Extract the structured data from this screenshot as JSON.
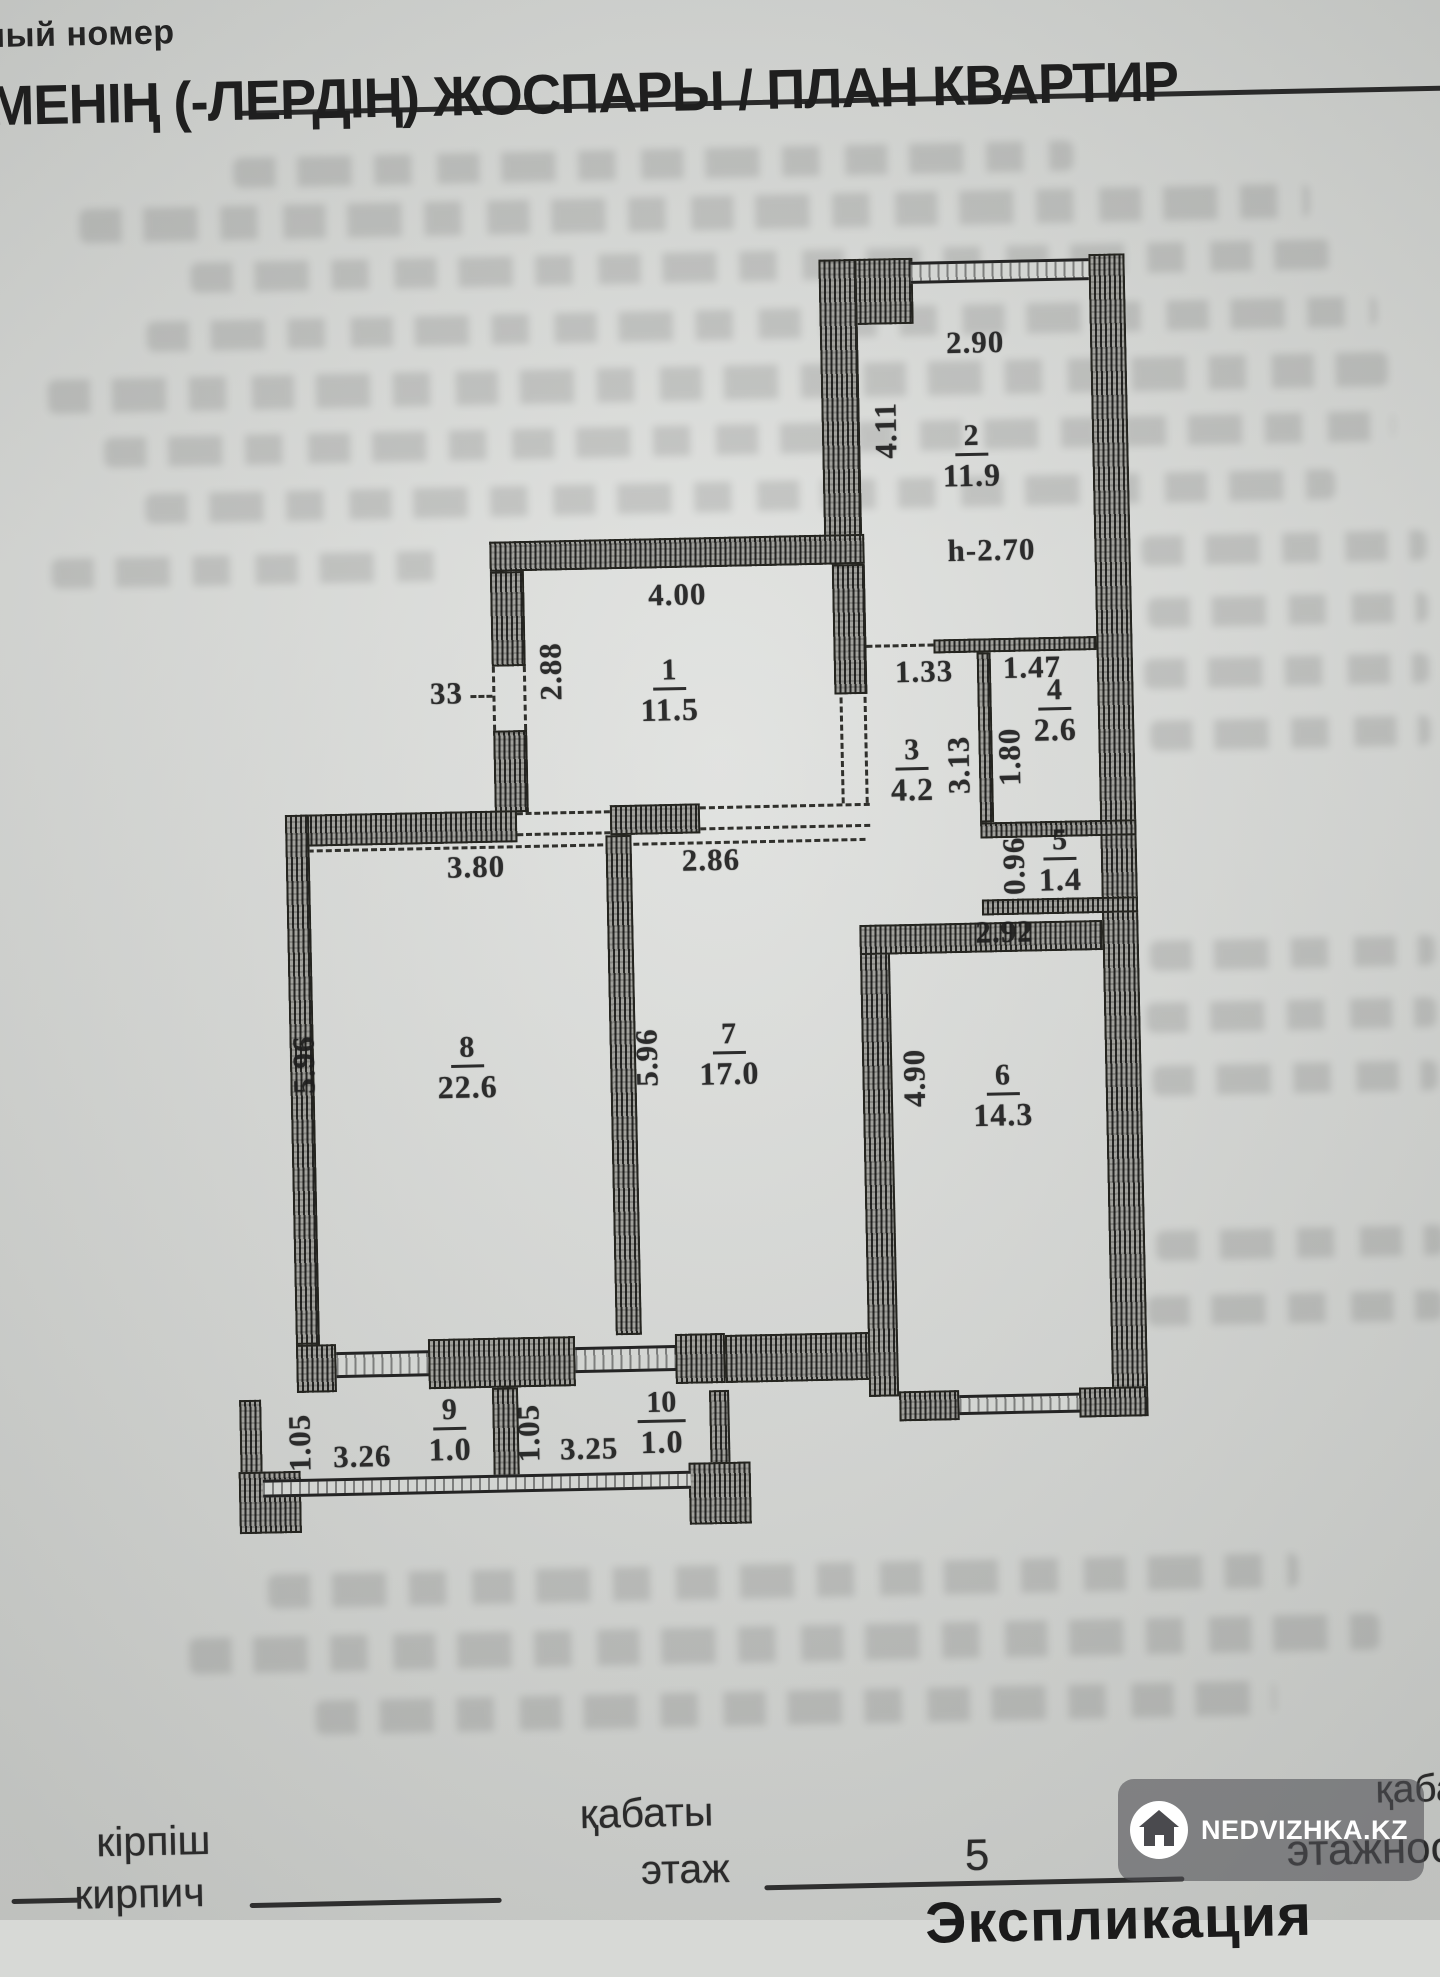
{
  "document": {
    "top_left_partial": "ный номер",
    "title_partial": "ЛМЕНІҢ (-ЛЕРДІҢ) ЖОСПАРЫ / ПЛАН КВАРТИР",
    "section_bottom_partial": "Экспликация"
  },
  "plan": {
    "rooms": [
      {
        "number": "1",
        "area": "11.5",
        "width": "4.00",
        "depth": "2.88",
        "window": "33"
      },
      {
        "number": "2",
        "area": "11.9",
        "width": "2.90",
        "depth": "4.11",
        "ceiling_height": "h-2.70"
      },
      {
        "number": "3",
        "area": "4.2",
        "width": "1.33",
        "depth": "3.13"
      },
      {
        "number": "4",
        "area": "2.6",
        "width": "1.47",
        "depth": "1.80"
      },
      {
        "number": "5",
        "area": "1.4",
        "depth": "0.96"
      },
      {
        "number": "6",
        "area": "14.3",
        "width": "2.92",
        "depth": "4.90"
      },
      {
        "number": "7",
        "area": "17.0",
        "width": "2.86",
        "depth": "5.96"
      },
      {
        "number": "8",
        "area": "22.6",
        "width": "3.80",
        "depth": "5.96"
      },
      {
        "number": "9",
        "area": "1.0",
        "width": "3.26",
        "depth": "1.05"
      },
      {
        "number": "10",
        "area": "1.0",
        "width": "3.25",
        "depth": "1.05"
      }
    ]
  },
  "footer": {
    "wall_material_kk": "кірпіш",
    "wall_material_ru": "кирпич",
    "floor_label_kk": "қабаты",
    "floor_label_ru": "этаж",
    "floor_value": "5",
    "storeys_label_kk_partial": "қабат-ғы",
    "storeys_label_ru_partial": "этажност"
  },
  "watermark": {
    "text": "NEDVIZHKA.KZ",
    "icon": "house-icon"
  },
  "colors": {
    "paper": "#d7d9d6",
    "ink": "#1f1f1f",
    "wall": "#92928e",
    "badge": "rgba(78,78,82,0.58)"
  }
}
